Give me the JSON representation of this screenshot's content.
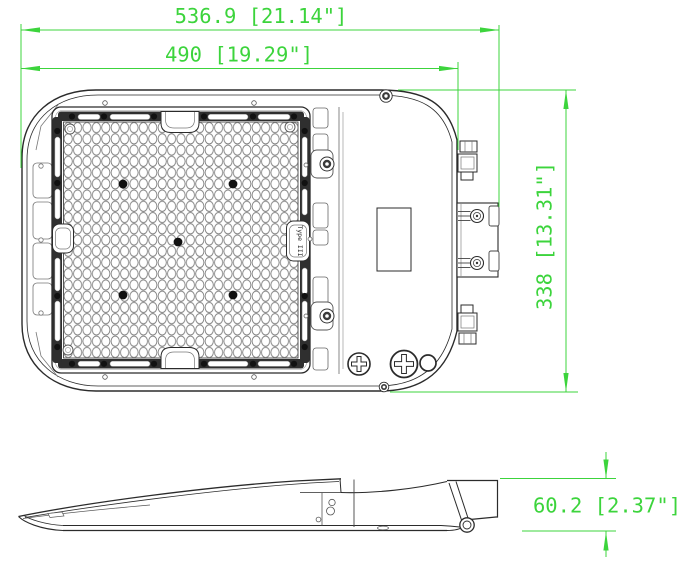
{
  "drawing": {
    "dimensions": {
      "overall_length": "536.9 [21.14\"]",
      "body_length": "490 [19.29\"]",
      "body_height": "338 [13.31\"]",
      "side_height": "60.2 [2.37\"]"
    },
    "labels": {
      "optic_type": "Type III"
    }
  },
  "colors": {
    "dimension_green": "#3cd43c",
    "drawing_line": "#2b2b2b",
    "background": "#ffffff"
  }
}
